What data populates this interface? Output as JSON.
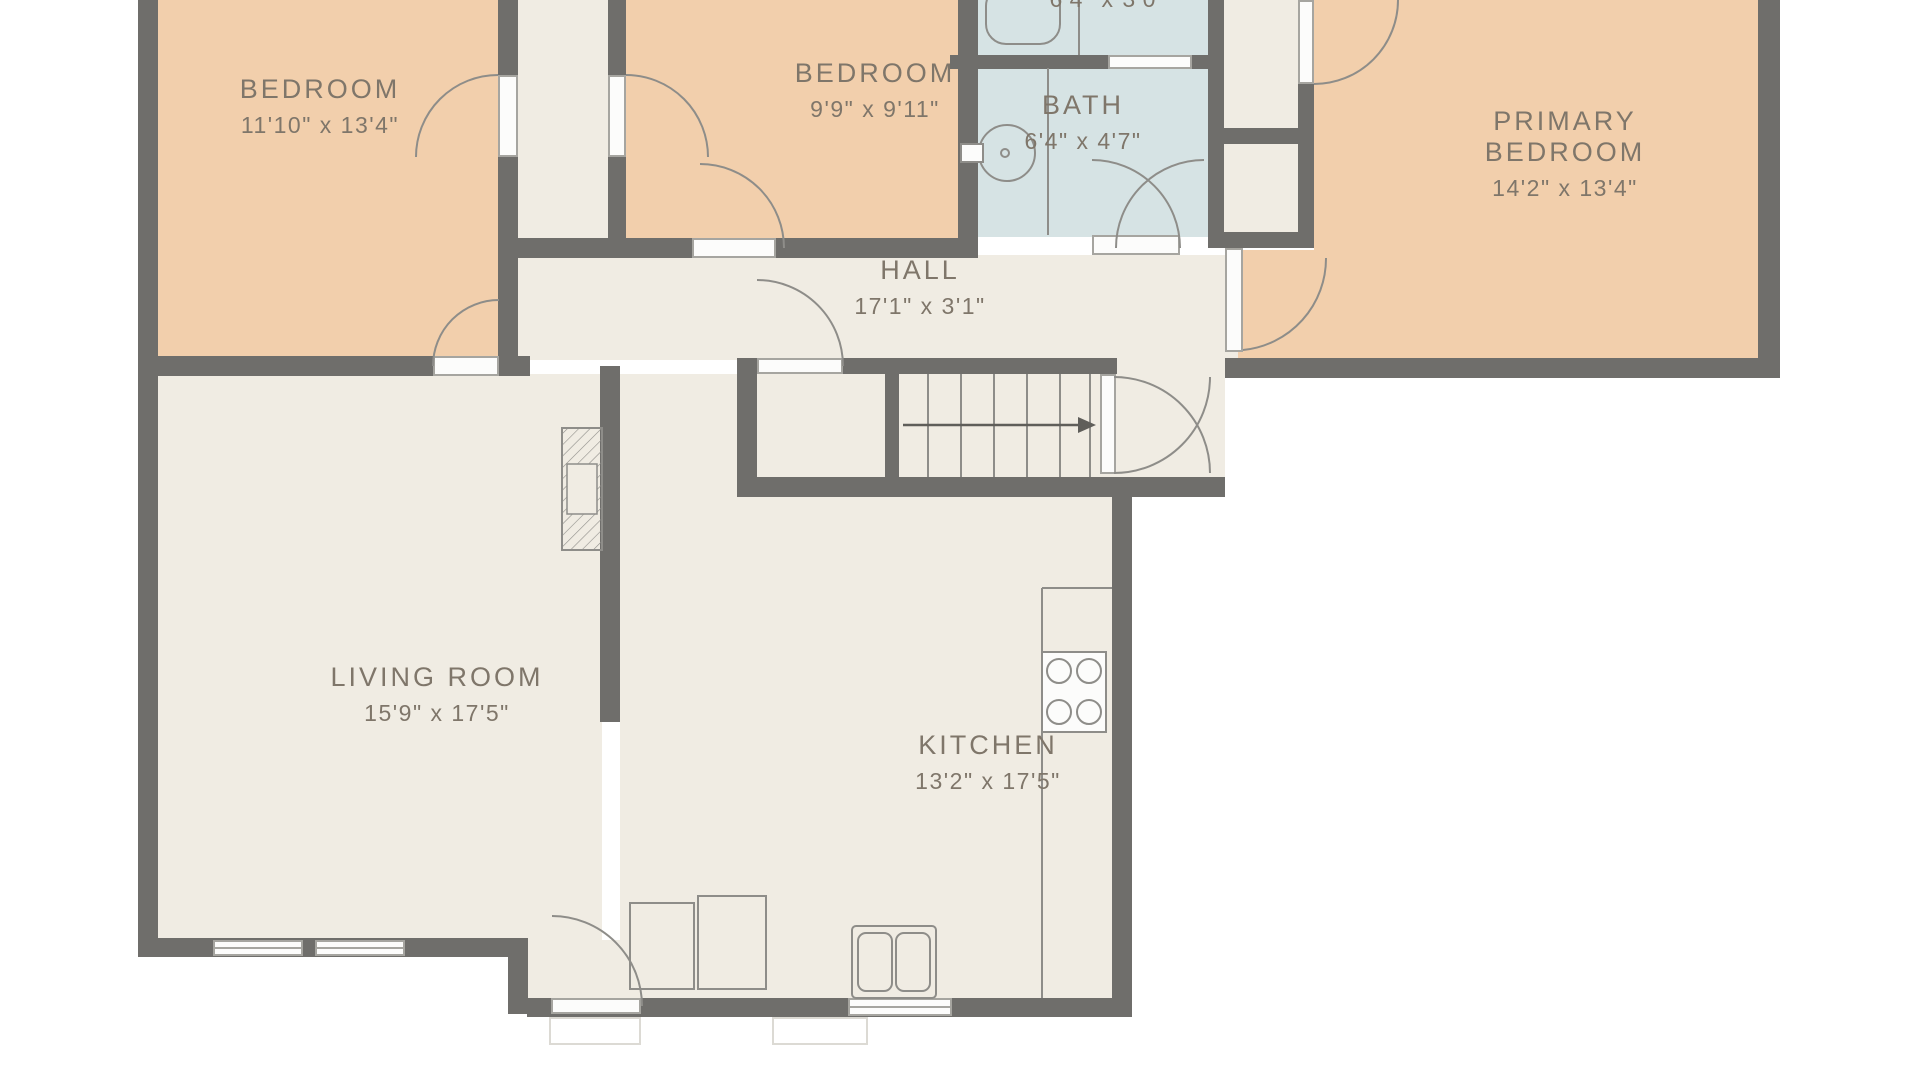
{
  "rooms": [
    {
      "id": "bedroom1",
      "name": "BEDROOM",
      "dims": "11'10\" x 13'4\""
    },
    {
      "id": "bedroom2",
      "name": "BEDROOM",
      "dims": "9'9\" x 9'11\""
    },
    {
      "id": "bath_top",
      "name": "",
      "dims": "6'4\" x 3'0\""
    },
    {
      "id": "bath",
      "name": "BATH",
      "dims": "6'4\" x 4'7\""
    },
    {
      "id": "primary_bedroom",
      "name": "PRIMARY BEDROOM",
      "dims": "14'2\" x 13'4\""
    },
    {
      "id": "hall",
      "name": "HALL",
      "dims": "17'1\" x 3'1\""
    },
    {
      "id": "living_room",
      "name": "LIVING ROOM",
      "dims": "15'9\" x 17'5\""
    },
    {
      "id": "kitchen",
      "name": "KITCHEN",
      "dims": "13'2\" x 17'5\""
    }
  ],
  "colors": {
    "bg": "#ffffff",
    "wall": "#6f6e6b",
    "bedroom_fill": "#f2cfac",
    "bath_fill": "#d6e3e4",
    "floor_fill": "#f0ece3",
    "leaf": "#fcfcfb",
    "leafline": "#a6a5a0",
    "line": "#8e8d89",
    "text": "#7f766a"
  }
}
